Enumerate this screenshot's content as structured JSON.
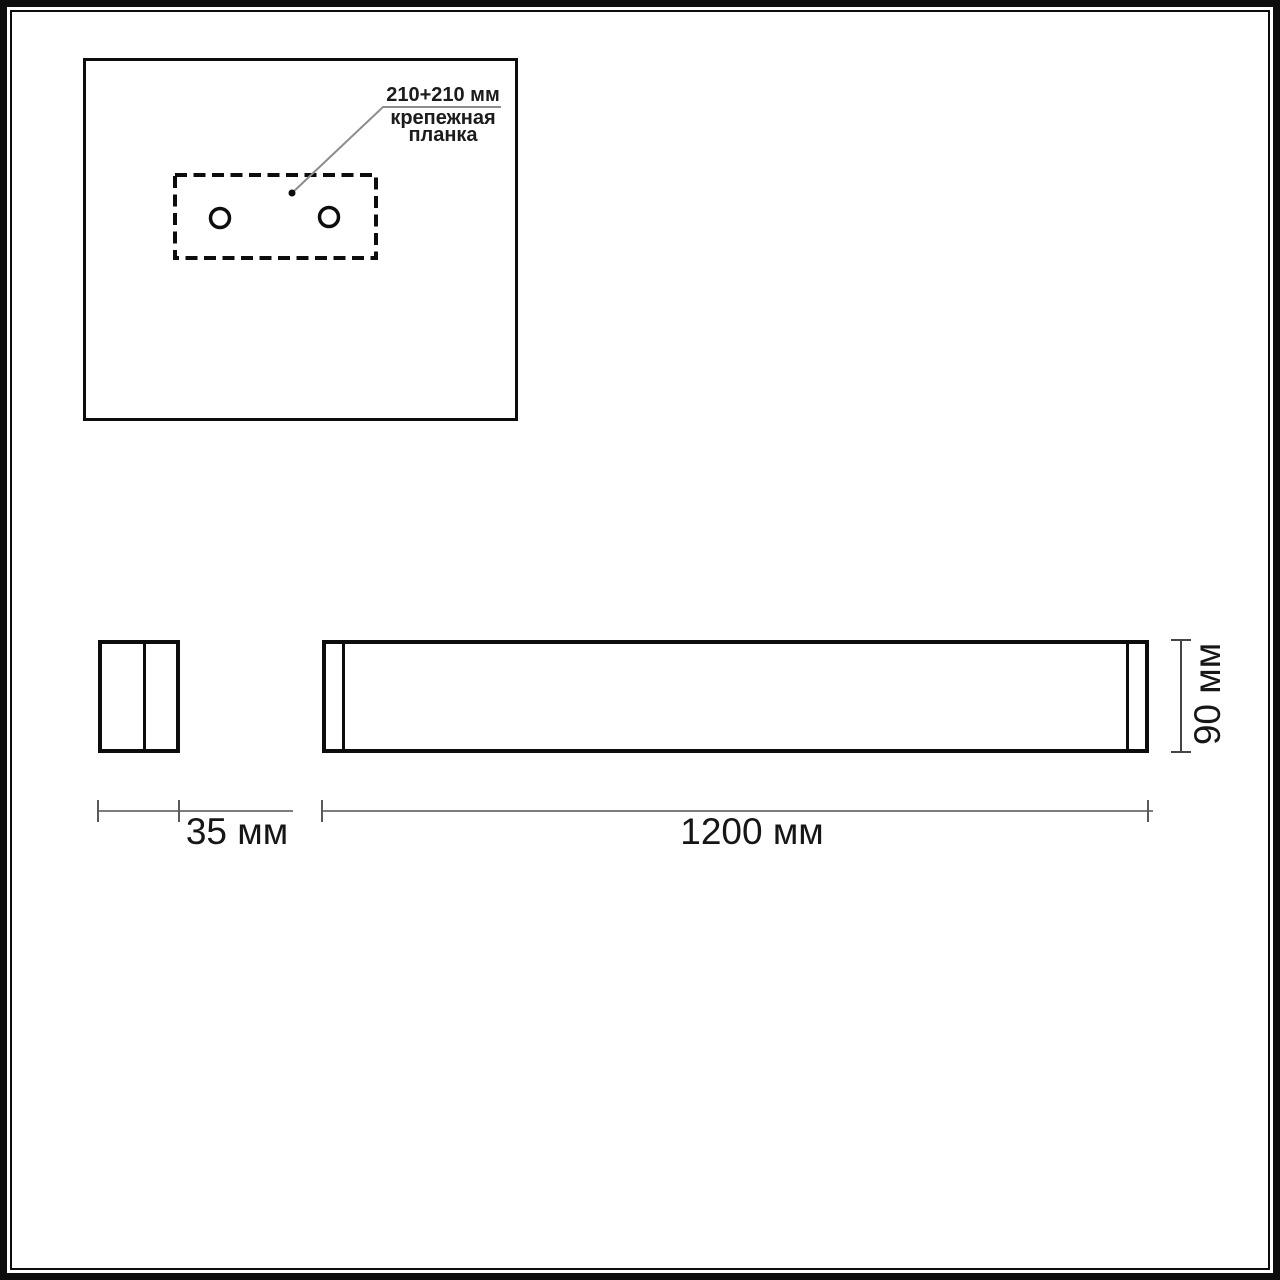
{
  "mounting_panel": {
    "spacing_label": "210+210 мм",
    "caption_line1": "крепежная",
    "caption_line2": "планка"
  },
  "dimensions": {
    "depth_label": "35 мм",
    "length_label": "1200 мм",
    "height_label": "90 мм"
  },
  "colors": {
    "background": "#ffffff",
    "drawing_line": "#0d0d0d",
    "dimension_line": "#7d7d7d",
    "text": "#1c1c1c"
  }
}
